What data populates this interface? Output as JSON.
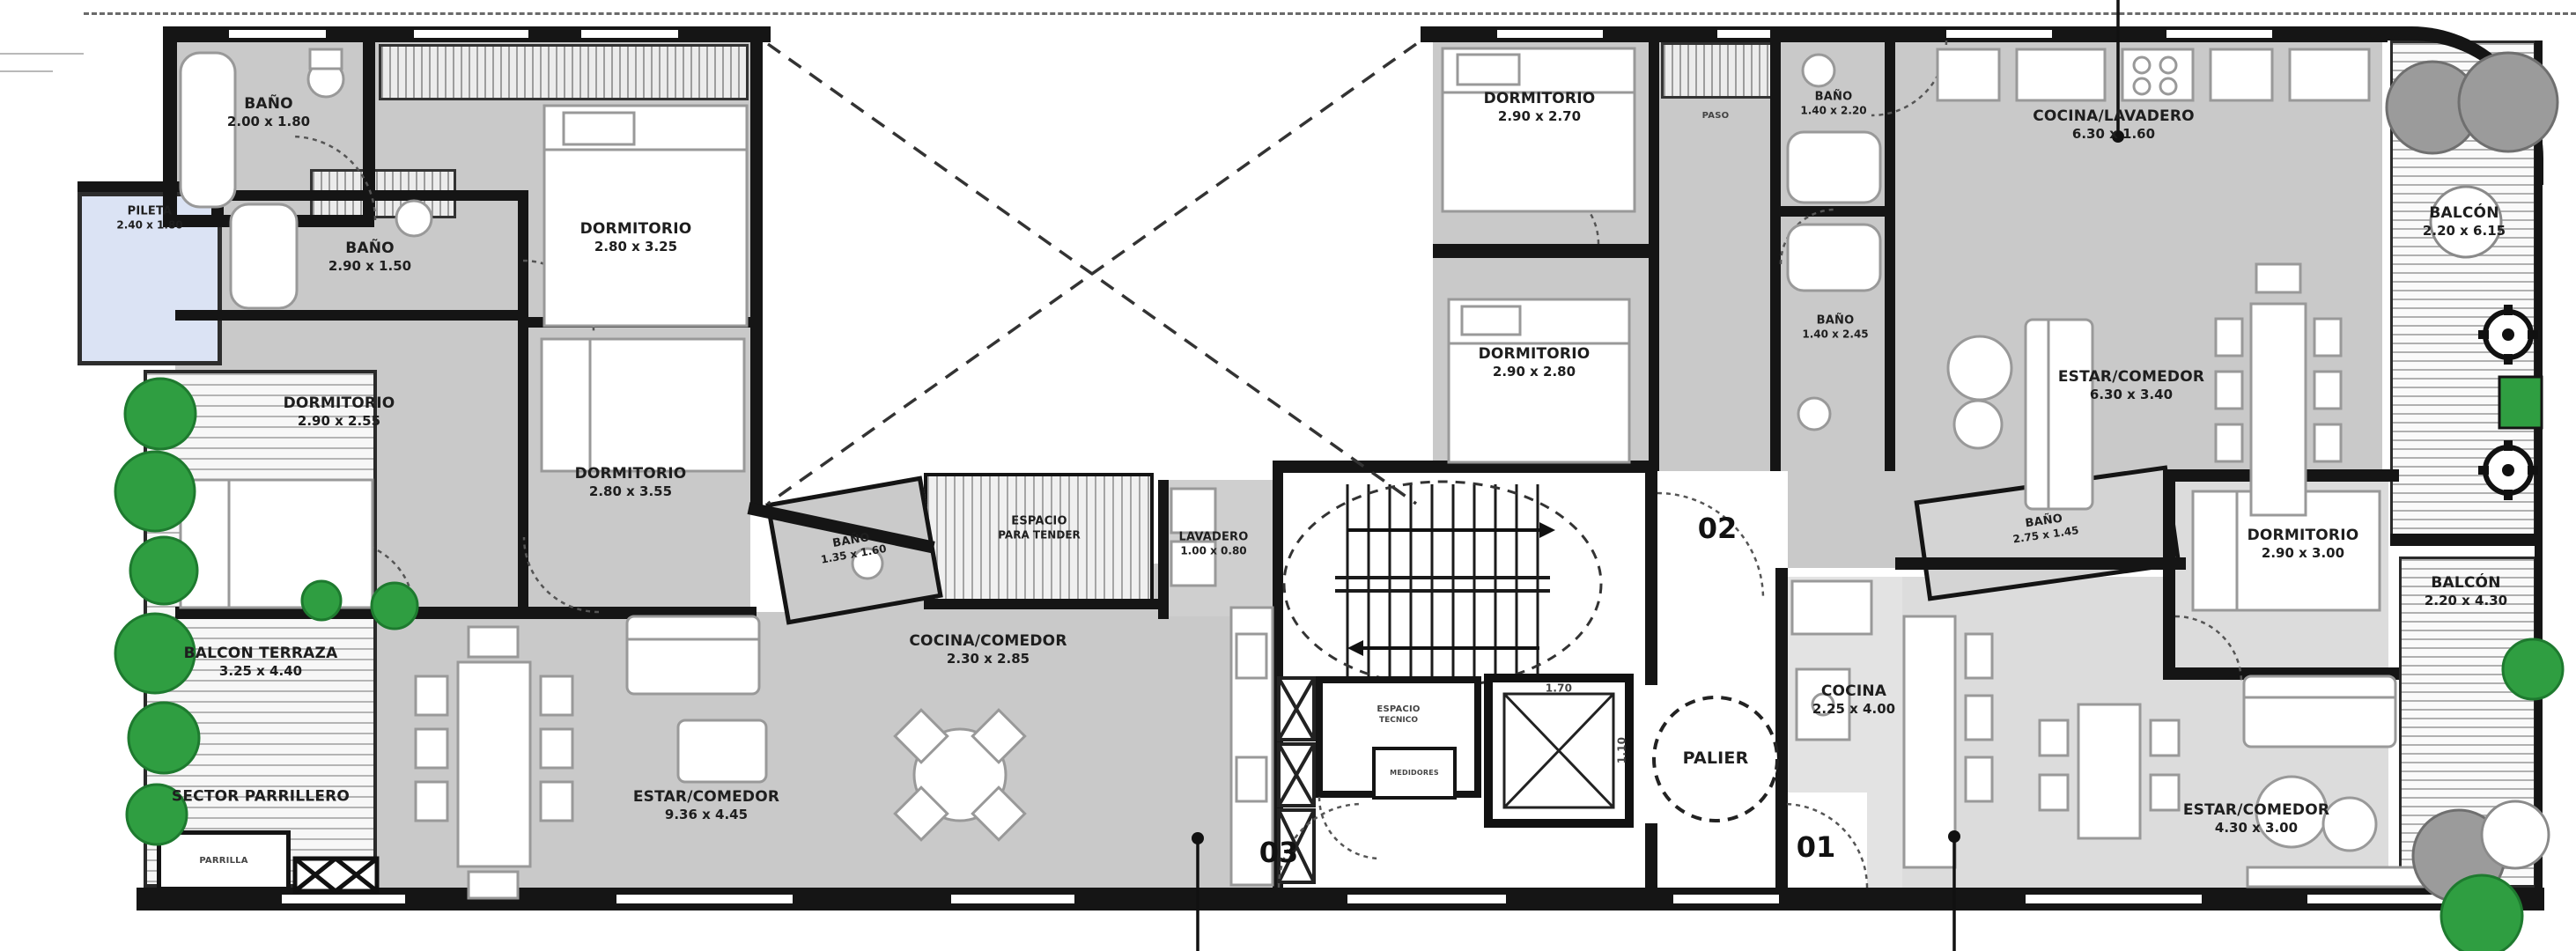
{
  "u03": {
    "badge": "03",
    "banio_top": {
      "name": "BAÑO",
      "dims": "2.00 x 1.80"
    },
    "pileta": {
      "name": "PILETA",
      "dims": "2.40 x 1.80"
    },
    "banio_mid": {
      "name": "BAÑO",
      "dims": "2.90 x 1.50"
    },
    "dorm_a": {
      "name": "DORMITORIO",
      "dims": "2.80 x 3.25"
    },
    "dorm_b": {
      "name": "DORMITORIO",
      "dims": "2.90 x 2.55"
    },
    "dorm_c": {
      "name": "DORMITORIO",
      "dims": "2.80 x 3.55"
    },
    "banio_small": {
      "name": "BAÑO",
      "dims": "1.35 x 1.60"
    },
    "tender": {
      "name": "ESPACIO",
      "dims": "PARA TENDER"
    },
    "lavadero": {
      "name": "LAVADERO",
      "dims": "1.00 x 0.80"
    },
    "cocina_comedor": {
      "name": "COCINA/COMEDOR",
      "dims": "2.30 x 2.85"
    },
    "estar_comedor": {
      "name": "ESTAR/COMEDOR",
      "dims": "9.36 x 4.45"
    },
    "balcon_terraza": {
      "name": "BALCON TERRAZA",
      "dims": "3.25 x 4.40"
    },
    "sector_parrillero": {
      "name": "SECTOR PARRILLERO"
    },
    "parrilla": {
      "name": "PARRILLA"
    }
  },
  "u02": {
    "badge": "02",
    "dorm_a": {
      "name": "DORMITORIO",
      "dims": "2.90 x 2.70"
    },
    "paso": {
      "name": "PASO"
    },
    "banio_a": {
      "name": "BAÑO",
      "dims": "1.40 x 2.20"
    },
    "cocina_lavadero": {
      "name": "COCINA/LAVADERO",
      "dims": "6.30 x 1.60"
    },
    "dorm_b": {
      "name": "DORMITORIO",
      "dims": "2.90 x 2.80"
    },
    "banio_b": {
      "name": "BAÑO",
      "dims": "1.40 x 2.45"
    },
    "estar_comedor": {
      "name": "ESTAR/COMEDOR",
      "dims": "6.30 x 3.40"
    },
    "balcon": {
      "name": "BALCÓN",
      "dims": "2.20 x 6.15"
    }
  },
  "u01": {
    "badge": "01",
    "banio": {
      "name": "BAÑO",
      "dims": "2.75 x 1.45"
    },
    "dorm": {
      "name": "DORMITORIO",
      "dims": "2.90 x 3.00"
    },
    "cocina": {
      "name": "COCINA",
      "dims": "2.25 x 4.00"
    },
    "estar_comedor": {
      "name": "ESTAR/COMEDOR",
      "dims": "4.30 x 3.00"
    },
    "balcon": {
      "name": "BALCÓN",
      "dims": "2.20 x 4.30"
    }
  },
  "core": {
    "palier": "PALIER",
    "espacio_tecnico": {
      "name": "ESPACIO",
      "dims": "TECNICO"
    },
    "medidores": "MEDIDORES",
    "elevator": {
      "w": "1.70",
      "d": "1.10"
    }
  }
}
